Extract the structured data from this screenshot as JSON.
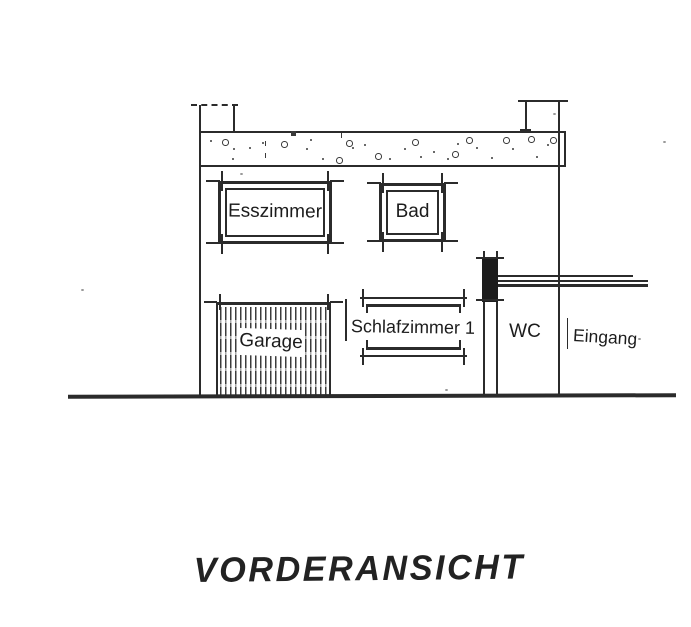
{
  "title": "VORDERANSICHT",
  "labels": {
    "esszimmer": "Esszimmer",
    "bad": "Bad",
    "garage": "Garage",
    "schlafzimmer1": "Schlafzimmer 1",
    "wc": "WC",
    "eingang": "Eingang"
  },
  "colors": {
    "ink": "#2b2b2b",
    "paper": "#ffffff",
    "pillar_fill": "#1c1c1c"
  }
}
